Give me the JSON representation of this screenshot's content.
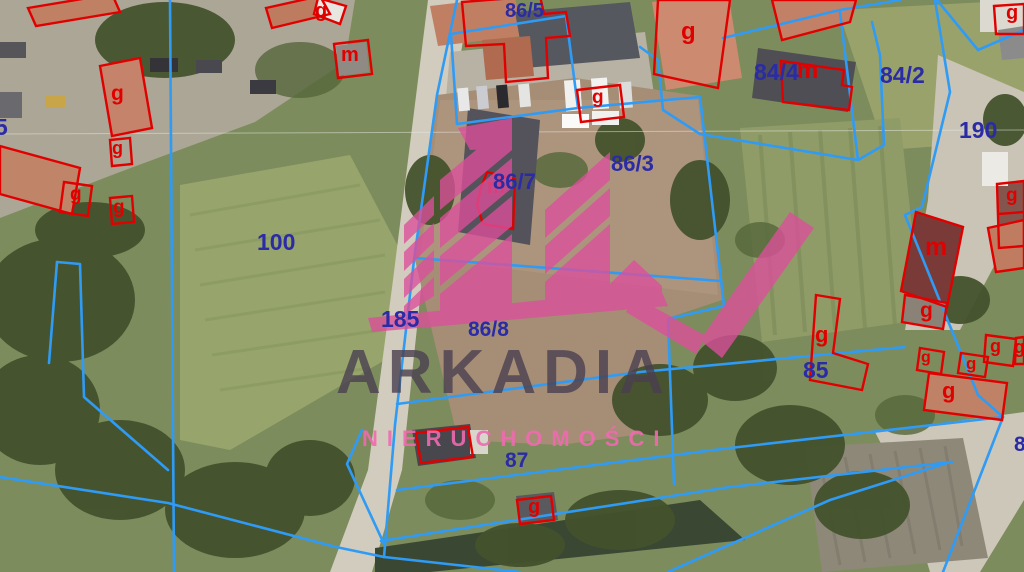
{
  "map": {
    "type": "cadastral-parcel-overlay-on-satellite",
    "watermark": {
      "brand": "ARKADIA",
      "tagline": "NIERUCHOMOŚCI"
    },
    "colors": {
      "parcel_boundary_line": "#2f9bf5",
      "building_outline": "#e10000",
      "parcel_number_text": "#2b2ba6",
      "watermark_pink": "#dc4f9b",
      "watermark_title": "#4a4050"
    },
    "parcel_labels": [
      {
        "text": "86/5"
      },
      {
        "text": "86/4"
      },
      {
        "text": "86/3"
      },
      {
        "text": "86/7"
      },
      {
        "text": "86/8"
      },
      {
        "text": "84/4"
      },
      {
        "text": "84/2"
      },
      {
        "text": "190"
      },
      {
        "text": "100"
      },
      {
        "text": "185"
      },
      {
        "text": "85"
      },
      {
        "text": "87"
      },
      {
        "text": "5"
      },
      {
        "text": "8"
      }
    ],
    "building_labels": [
      {
        "text": "g"
      },
      {
        "text": "m"
      },
      {
        "text": "g"
      },
      {
        "text": "g"
      },
      {
        "text": "g"
      },
      {
        "text": "g"
      },
      {
        "text": "g"
      },
      {
        "text": "g"
      },
      {
        "text": "m"
      },
      {
        "text": "g"
      },
      {
        "text": "g"
      },
      {
        "text": "m"
      },
      {
        "text": "g"
      },
      {
        "text": "g"
      },
      {
        "text": "m"
      },
      {
        "text": "g"
      },
      {
        "text": "g"
      },
      {
        "text": "g"
      },
      {
        "text": "g"
      },
      {
        "text": "g"
      },
      {
        "text": "g"
      }
    ]
  }
}
